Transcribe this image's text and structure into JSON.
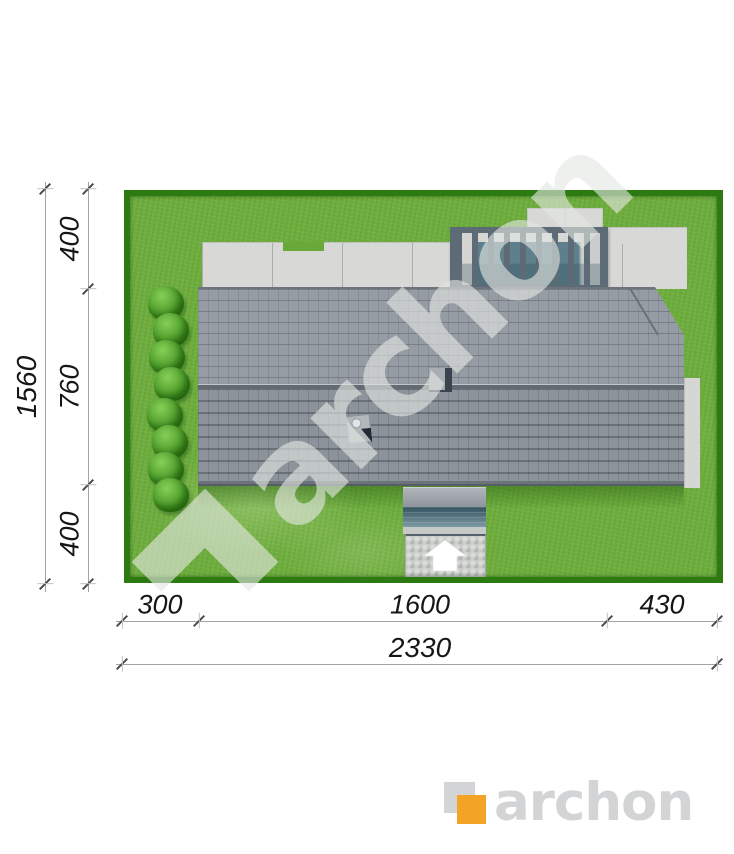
{
  "plan": {
    "type": "house-site-plan-top-view",
    "dimensions": {
      "left": {
        "total": "1560",
        "segments": [
          "400",
          "760",
          "400"
        ]
      },
      "bottom": {
        "total": "2330",
        "segments": [
          "300",
          "1600",
          "430"
        ]
      }
    },
    "watermark": {
      "text": "archon"
    },
    "brand": {
      "logo_text": "archon"
    },
    "colors": {
      "grass": "#6fae3e",
      "hedge": "#2c7a12",
      "roof_upper": "#959ca4",
      "roof_lower": "#8c939b",
      "terrace": "#d8d8d6",
      "pergola_frame": "#5d6b77",
      "glazing": "#5e7f8b",
      "paving": "#c8cbc8",
      "logo_orange": "#f4a425",
      "logo_gray": "#d3d4d6",
      "dimension_text": "#161616",
      "dimension_line": "#a3a3a3"
    },
    "icons": {
      "entrance_arrow": "white up-arrow at driveway entrance",
      "bush": "garden shrub",
      "chimney": "roof chimney vent"
    }
  }
}
